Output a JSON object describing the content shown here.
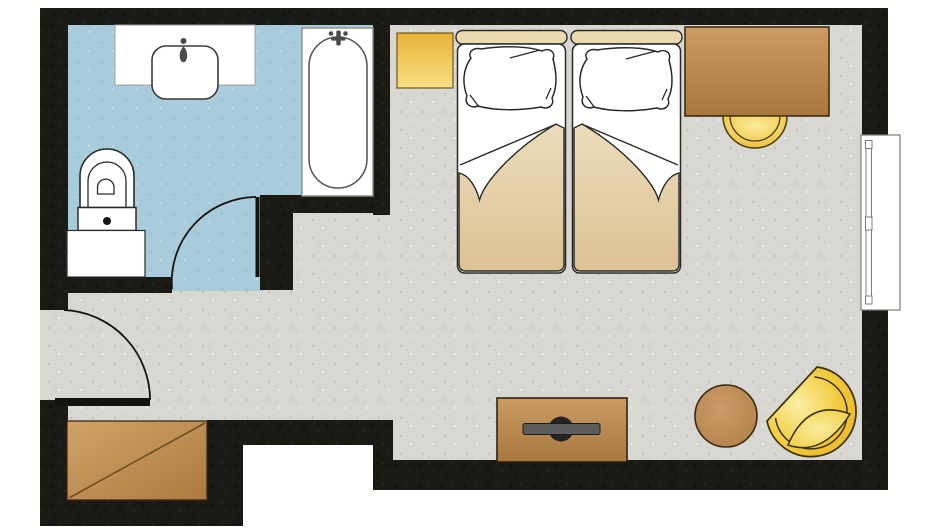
{
  "app": {
    "type": "floor-plan"
  },
  "colors": {
    "outside": "#ffffff",
    "wall": "#1b1913",
    "wall_speck_dark": "#11100b",
    "wall_speck_light": "#262317",
    "floor_gray": "#d8d7d1",
    "gray_speck_dark": "#c4c3bb",
    "gray_speck_light": "#efeeea",
    "floor_blue": "#a9ccdc",
    "blue_speck_dark": "#93bccd",
    "blue_speck_light": "#c8e0ea",
    "line_dark": "#2a2a28",
    "door": "#15130e",
    "fixture_white": "#ffffff",
    "tub_frame": "#8d8d8b",
    "metal": "#4a4a48",
    "counter_edge": "#a0a09c",
    "headboard": "#ecd9b1",
    "blanket_top": "#ecdcbb",
    "blanket_bottom": "#dcc294",
    "gold_top": "#e9b238",
    "gold_bottom": "#f8e083",
    "gold_highlight": "#faec9c",
    "gold_mid": "#f3cd55",
    "gold_deep": "#e8b02c",
    "gold_stroke": "#4a3a10",
    "chair_highlight": "#fbf0a8",
    "chair_mid": "#f2ca39",
    "chair_deep": "#e6ab25",
    "chair_stroke": "#3c3006",
    "brown_top": "#cb9d64",
    "brown_bottom": "#a6773e",
    "brown_stroke": "#33250f",
    "closet_light": "#d2a368",
    "closet_dark": "#aa7a41",
    "closet_line": "#6e4f26",
    "table_light": "#cb9c68",
    "table_dark": "#b07c46",
    "table_stroke": "#3a2a12",
    "tv_bar": "#5d5d5d",
    "tv_hub": "#232323",
    "window_frame": "#7c7c7a"
  },
  "rooms": {
    "bathroom": {
      "floor_color_key": "floor_blue",
      "items": [
        "washbasin-counter",
        "washbasin",
        "bathtub",
        "toilet",
        "vanity-cabinet",
        "bathroom-door"
      ]
    },
    "bedroom": {
      "floor_color_key": "floor_gray",
      "items": [
        "nightstand",
        "twin-bed-left",
        "twin-bed-right",
        "desk",
        "desk-stool",
        "window",
        "tv-cabinet",
        "tv",
        "side-table",
        "armchair",
        "wardrobe",
        "entry-door"
      ]
    }
  }
}
